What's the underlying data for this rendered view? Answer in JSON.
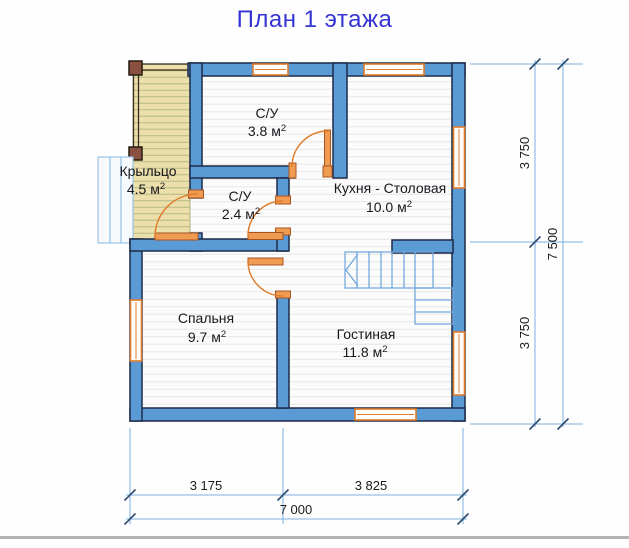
{
  "title": "План 1 этажа",
  "rooms": [
    {
      "name": "Крыльцо",
      "area_value": "4.5 м",
      "area_sup": "2"
    },
    {
      "name": "С/У",
      "area_value": "3.8 м",
      "area_sup": "2"
    },
    {
      "name": "С/У",
      "area_value": "2.4 м",
      "area_sup": "2"
    },
    {
      "name": "Кухня - Столовая",
      "area_value": "10.0 м",
      "area_sup": "2"
    },
    {
      "name": "Спальня",
      "area_value": "9.7 м",
      "area_sup": "2"
    },
    {
      "name": "Гостиная",
      "area_value": "11.8 м",
      "area_sup": "2"
    }
  ],
  "dimensions": {
    "right_upper": "3 750",
    "right_lower": "3 750",
    "right_total": "7 500",
    "bottom_left": "3 175",
    "bottom_right": "3 825",
    "bottom_total": "7 000"
  },
  "colors": {
    "wall": "#5b9bd5",
    "wall_outline": "#1d2b49",
    "joinery_orange": "#e07b28",
    "dimension_line": "#7cb0e3",
    "title_blue": "#3534d4",
    "porch_deck": "#ecdfab"
  }
}
